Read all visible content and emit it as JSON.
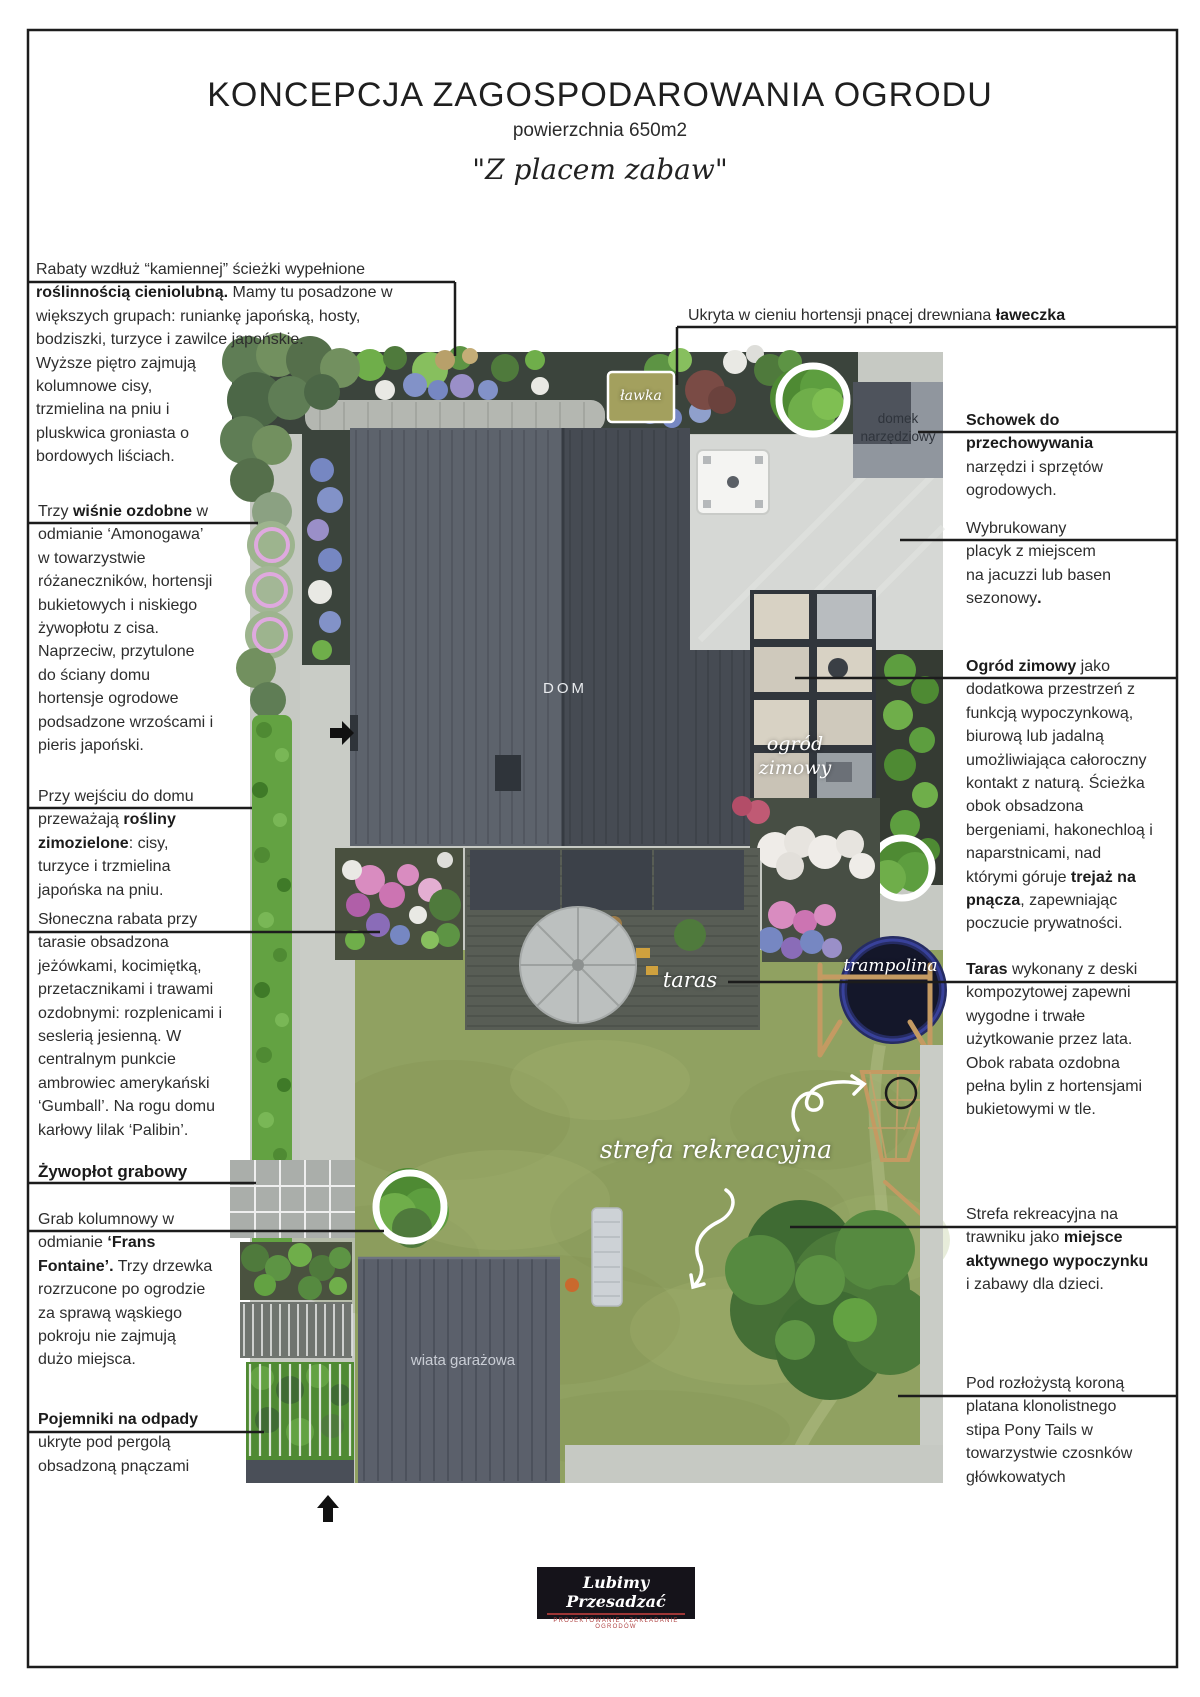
{
  "header": {
    "title": "KONCEPCJA ZAGOSPODAROWANIA OGRODU",
    "subtitle": "powierzchnia 650m2",
    "tagline": "\"Z placem zabaw\""
  },
  "annotations_left": [
    {
      "id": "rabaty",
      "html": "Rabaty wzdłuż “kamiennej” ścieżki wypełnione\n<b>roślinnością cieniolubną.</b> Mamy tu posadzone w\nwiększych grupach: runiankę japońską, hosty,\nbodziszki, turzyce i zawilce japońskie.\nWyższe piętro zajmują\nkolumnowe cisy,\ntrzmielina na pniu i\npluskwica groniasta o\nbordowych liściach."
    },
    {
      "id": "wisnie",
      "html": "Trzy <b>wiśnie ozdobne</b> w\nodmianie ‘Amonogawa’\nw towarzystwie\nróżaneczników, hortensji\nbukietowych i niskiego\nżywopłotu z cisa.\nNaprzeciw, przytulone\ndo ściany domu\nhortensje ogrodowe\npodsadzone wrzoścami i\npieris japoński."
    },
    {
      "id": "wejscie",
      "html": "Przy wejściu do domu\nprzeważają <b>rośliny\nzimozielone</b>: cisy,\nturzyce i trzmielina\njapońska na pniu."
    },
    {
      "id": "sloneczna",
      "html": "Słoneczna rabata przy\ntarasie obsadzona\njeżówkami, kocimiętką,\nprzetacznikami i trawami\nozdobnymi: rozplenicami i\nseslerią jesienną. W\ncentralnym punkcie\nambrowiec amerykański\n‘Gumball’. Na rogu domu\nkarłowy lilak ‘Palibin’."
    },
    {
      "id": "zywoplot",
      "html": "<b>Żywopłot grabowy</b>"
    },
    {
      "id": "grab",
      "html": "Grab kolumnowy w\nodmianie <b>‘Frans\nFontaine’.</b> Trzy drzewka\nrozrzucone po ogrodzie\nza sprawą wąskiego\npokroju nie zajmują\ndużo miejsca."
    },
    {
      "id": "pojemniki",
      "html": "<b>Pojemniki na odpady</b>\nukryte pod pergolą\nobsadzoną pnączami"
    }
  ],
  "annotations_right": [
    {
      "id": "laweczka",
      "html": "Ukryta w cieniu hortensji pnącej drewniana <b>ławeczka</b>"
    },
    {
      "id": "schowek",
      "html": "<b>Schowek do\nprzechowywania</b>\nnarzędzi i sprzętów\nogrodowych."
    },
    {
      "id": "placyk",
      "html": "Wybrukowany\nplacyk z miejscem\nna jacuzzi lub basen\nsezonowy<b>.</b>"
    },
    {
      "id": "ogrod-zimowy",
      "html": "<b>Ogród zimowy</b> jako\ndodatkowa przestrzeń z\nfunkcją wypoczynkową,\nbiurową lub jadalną\numożliwiająca całoroczny\nkontakt z naturą. Ścieżka\nobok obsadzona\nbergeniami, hakonechloą i\nnaparstnicami, nad\nktórymi góruje <b>trejaż na\npnącza</b>, zapewniając\npoczucie prywatności."
    },
    {
      "id": "taras",
      "html": "<b>Taras</b> wykonany z deski\nkompozytowej zapewni\nwygodne i trwałe\nużytkowanie przez lata.\nObok rabata ozdobna\npełna bylin z hortensjami\nbukietowymi w tle."
    },
    {
      "id": "strefa",
      "html": "Strefa rekreacyjna na\ntrawniku jako <b>miejsce\naktywnego wypoczynku</b>\ni zabawy dla dzieci."
    },
    {
      "id": "platan",
      "html": "Pod rozłożystą koroną\nplatana klonolistnego\nstipa Pony Tails w\ntowarzystwie czosnków\ngłówkowatych"
    }
  ],
  "plan_labels": {
    "lawka": "ławka",
    "domek_narzedziowy": "domek\nnarzędziowy",
    "dom": "DOM",
    "ogrod_zimowy": "ogród\nzimowy",
    "taras": "taras",
    "trampolina": "trampolina",
    "strefa_rekreacyjna": "strefa rekreacyjna",
    "wiata_garazowa": "wiata garażowa"
  },
  "logo": {
    "name": "Lubimy Przesadzać",
    "tagline": "PROJEKTOWANIE I ZAKŁADANIE OGRODÓW"
  },
  "colors": {
    "lawn": "#90a161",
    "hedge": "#63a242",
    "roof_dark": "#464b53",
    "roof_light": "#5d636c",
    "callout_line": "#1c1c1c",
    "cherry_ring": "#dfa9df",
    "highlight_ring": "#ffffff",
    "logo_bg": "#15131a",
    "logo_accent": "#b04444"
  }
}
